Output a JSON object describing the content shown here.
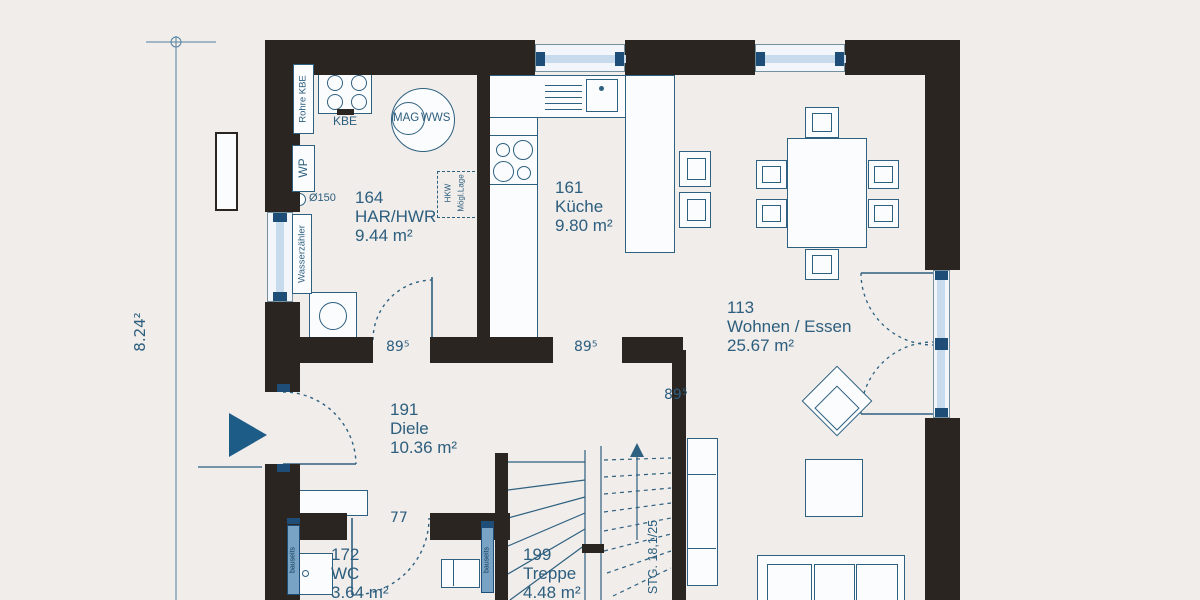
{
  "colors": {
    "background": "#f0edea",
    "wall": "#2b2522",
    "line": "#2e6080",
    "text": "#2d5e7e",
    "glazing": "#c7dbec",
    "accent": "#1e5c88",
    "radiator": "#78a3c4"
  },
  "rooms": [
    {
      "number": "164",
      "name": "HAR/HWR",
      "area": "9.44 m²"
    },
    {
      "number": "161",
      "name": "Küche",
      "area": "9.80 m²"
    },
    {
      "number": "113",
      "name": "Wohnen / Essen",
      "area": "25.67 m²"
    },
    {
      "number": "191",
      "name": "Diele",
      "area": "10.36 m²"
    },
    {
      "number": "172",
      "name": "WC",
      "area": "3.64 m²"
    },
    {
      "number": "199",
      "name": "Treppe",
      "area": "4.48 m²"
    }
  ],
  "door_labels": {
    "har": "89⁵",
    "kueche": "89⁵",
    "wohnen": "89⁵",
    "wc": "77"
  },
  "dimension": {
    "left_total": "8.24²"
  },
  "stairs": {
    "spec": "STG. 18,1/25"
  },
  "fixtures": {
    "rohre_kbe": "Rohre KBE",
    "kbe": "KBE",
    "mag": "MAG",
    "wws": "WWS",
    "wp": "WP",
    "durchmesser": "Ø150",
    "hkw_line1": "HKW",
    "hkw_line2": "Mögl.Lage",
    "wasserzaehler": "Wasserzähler",
    "radiator_wc": "bauseits",
    "radiator_treppe": "bauseits"
  }
}
